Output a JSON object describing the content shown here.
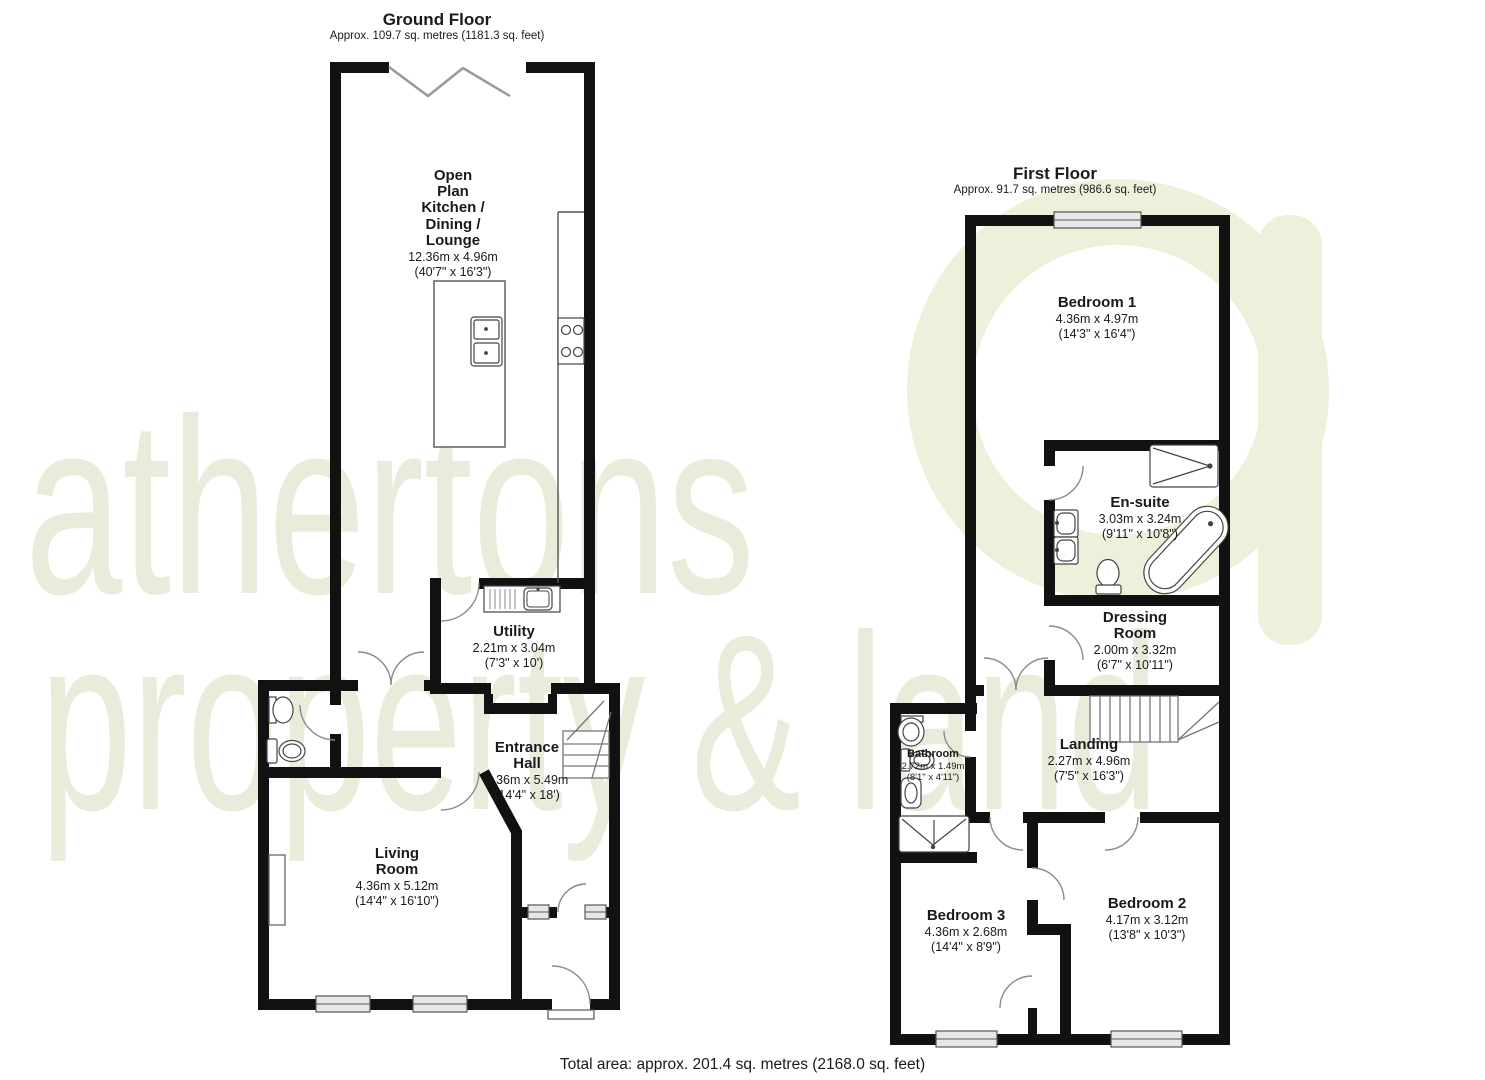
{
  "watermark": {
    "line1": "athertons",
    "line2": "property & land",
    "color": "#eaebdb"
  },
  "footer": {
    "total_area": "Total area: approx. 201.4 sq. metres (2168.0 sq. feet)"
  },
  "colors": {
    "wall": "#111111",
    "fixture": "#555555",
    "window_fill": "#e7e7e7",
    "accent_tint": "#eef0dc"
  },
  "ground_floor": {
    "title": "Ground Floor",
    "subtitle": "Approx. 109.7 sq. metres (1181.3 sq. feet)",
    "rooms": {
      "kitchen": {
        "name": "Open\nPlan\nKitchen /\nDining /\nLounge",
        "size_m": "12.36m x 4.96m",
        "size_ft": "(40'7\" x 16'3\")"
      },
      "utility": {
        "name": "Utility",
        "size_m": "2.21m x 3.04m",
        "size_ft": "(7'3\" x 10')"
      },
      "entrance_hall": {
        "name": "Entrance\nHall",
        "size_m": "4.36m x 5.49m",
        "size_ft": "(14'4\" x 18')"
      },
      "living_room": {
        "name": "Living\nRoom",
        "size_m": "4.36m x 5.12m",
        "size_ft": "(14'4\" x 16'10\")"
      }
    }
  },
  "first_floor": {
    "title": "First Floor",
    "subtitle": "Approx. 91.7 sq. metres (986.6 sq. feet)",
    "rooms": {
      "bedroom1": {
        "name": "Bedroom 1",
        "size_m": "4.36m x 4.97m",
        "size_ft": "(14'3\" x 16'4\")"
      },
      "ensuite": {
        "name": "En-suite",
        "size_m": "3.03m x 3.24m",
        "size_ft": "(9'11\" x 10'8\")"
      },
      "dressing": {
        "name": "Dressing\nRoom",
        "size_m": "2.00m x 3.32m",
        "size_ft": "(6'7\" x 10'11\")"
      },
      "landing": {
        "name": "Landing",
        "size_m": "2.27m x 4.96m",
        "size_ft": "(7'5\" x 16'3\")"
      },
      "bathroom": {
        "name": "Bathroom",
        "size_m": "2.72m x 1.49m",
        "size_ft": "(8'1\" x 4'11\")"
      },
      "bedroom3": {
        "name": "Bedroom 3",
        "size_m": "4.36m x 2.68m",
        "size_ft": "(14'4\" x 8'9\")"
      },
      "bedroom2": {
        "name": "Bedroom 2",
        "size_m": "4.17m x 3.12m",
        "size_ft": "(13'8\" x 10'3\")"
      }
    }
  }
}
